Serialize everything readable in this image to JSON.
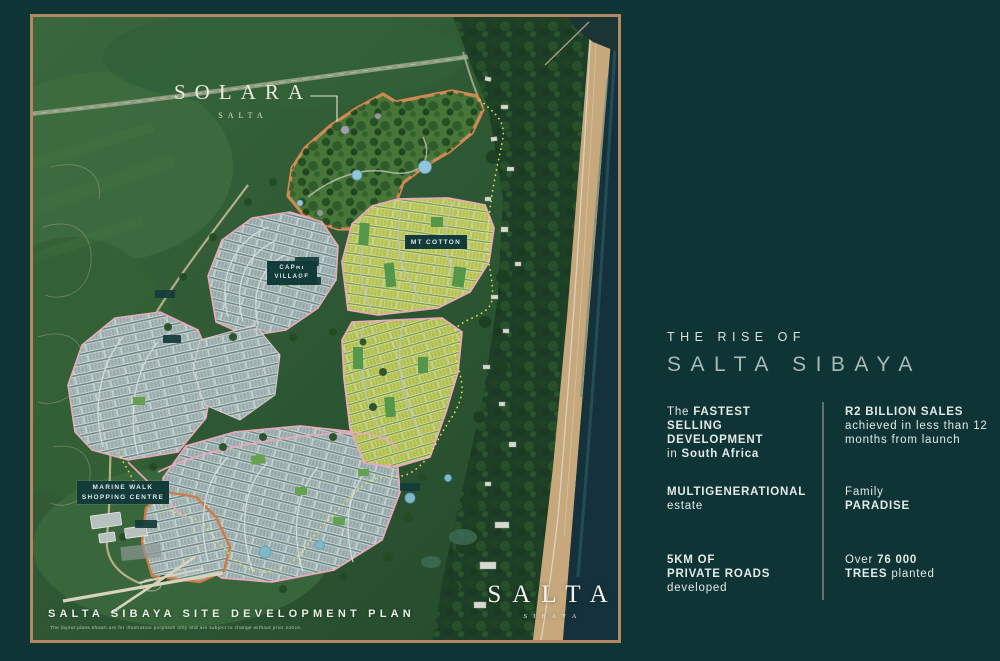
{
  "panel": {
    "eyebrow": "THE RISE OF",
    "title": "SALTA SIBAYA",
    "stats": {
      "fastest": {
        "pre": "The ",
        "b1": "FASTEST",
        "b2": "SELLING",
        "b3": "DEVELOPMENT",
        "pre2": "in ",
        "b4": "South Africa"
      },
      "sales": {
        "b1": "R2 BILLION SALES",
        "l2": "achieved in less than 12",
        "l3": "months from launch"
      },
      "multigen": {
        "b1": "MULTIGENERATIONAL",
        "sub": "estate"
      },
      "family": {
        "pre": "Family",
        "b1": "PARADISE"
      },
      "roads": {
        "b1": "5KM OF",
        "b2": "PRIVATE ROADS",
        "sub": "developed"
      },
      "trees": {
        "pre": "Over ",
        "b1": "76 000",
        "b2": "TREES",
        "sub": " planted"
      }
    }
  },
  "map": {
    "solara": {
      "name": "SOLARA",
      "brand": "SALTA"
    },
    "labels": {
      "mt_cotton": "MT COTTON",
      "capri_1": "CAPRI",
      "capri_2": "VILLAGE",
      "marine_1": "MARINE WALK",
      "marine_2": "SHOPPING CENTRE"
    },
    "plan_title": "SALTA SIBAYA SITE DEVELOPMENT PLAN",
    "disclaimer": "The layout plans shown are for illustration purposes only and are subject to change without prior notice.",
    "logo": {
      "name": "SALTA",
      "sub": "SIBAYA"
    }
  },
  "colors": {
    "background": "#0f3435",
    "frame": "#b38862",
    "boundary_orange": "#cf8a52",
    "road_pink": "#eaa9ba",
    "dotted_yellow": "#ece75f",
    "plots_yellow": "#b7c354",
    "plots_gray": "#9cadae",
    "label_teal": "#123b3a",
    "ocean": "#15323c",
    "beach": "#c7a87c"
  }
}
